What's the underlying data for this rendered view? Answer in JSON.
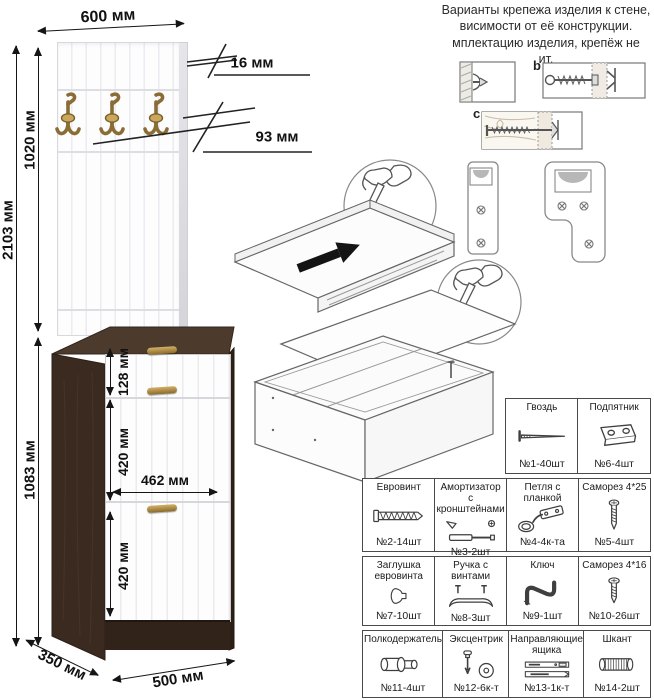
{
  "note": {
    "lines": [
      "Варианты крепежа изделия к стене,",
      "висимости от её конструкции.",
      "мплектацию изделия, крепёж не",
      "ит."
    ]
  },
  "wall_mount_labels": {
    "b": "b",
    "c": "c"
  },
  "dims": {
    "top_width": "600 мм",
    "thickness": "16 мм",
    "hook_spacing": "93 мм",
    "panel_height": "1020 мм",
    "total_height": "2103 мм",
    "cabinet_height": "1083 мм",
    "drawer_height": "128 мм",
    "upper_door_height": "420 мм",
    "inner_width": "462 мм",
    "lower_door_height": "420 мм",
    "depth": "350 мм",
    "bottom_width": "500 мм"
  },
  "parts": [
    {
      "name": "Гвоздь",
      "qty": "№1-40шт"
    },
    {
      "name": "Подпятник",
      "qty": "№6-4шт"
    },
    {
      "name": "Евровинт",
      "qty": "№2-14шт"
    },
    {
      "name": "Амортизатор",
      "name2": "с кронштейнами",
      "qty": "№3-2шт"
    },
    {
      "name": "Петля с планкой",
      "qty": "№4-4к-та"
    },
    {
      "name": "Саморез 4*25",
      "qty": "№5-4шт"
    },
    {
      "name": "Заглушка",
      "name2": "евровинта",
      "qty": "№7-10шт"
    },
    {
      "name": "Ручка с винтами",
      "qty": "№8-3шт"
    },
    {
      "name": "Ключ",
      "qty": "№9-1шт"
    },
    {
      "name": "Саморез 4*16",
      "qty": "№10-26шт"
    },
    {
      "name": "Полкодержатель",
      "qty": "№11-4шт"
    },
    {
      "name": "Эксцентрик",
      "qty": "№12-6к-т"
    },
    {
      "name": "Направляющие",
      "name2": "ящика",
      "qty": "№13-1к-т"
    },
    {
      "name": "Шкант",
      "qty": "№14-2шт"
    }
  ],
  "colors": {
    "carcass_dark": "#3a2a20",
    "front_white": "#fdfdfe",
    "brass": "#a8853f",
    "dimension_text": "#111111"
  }
}
